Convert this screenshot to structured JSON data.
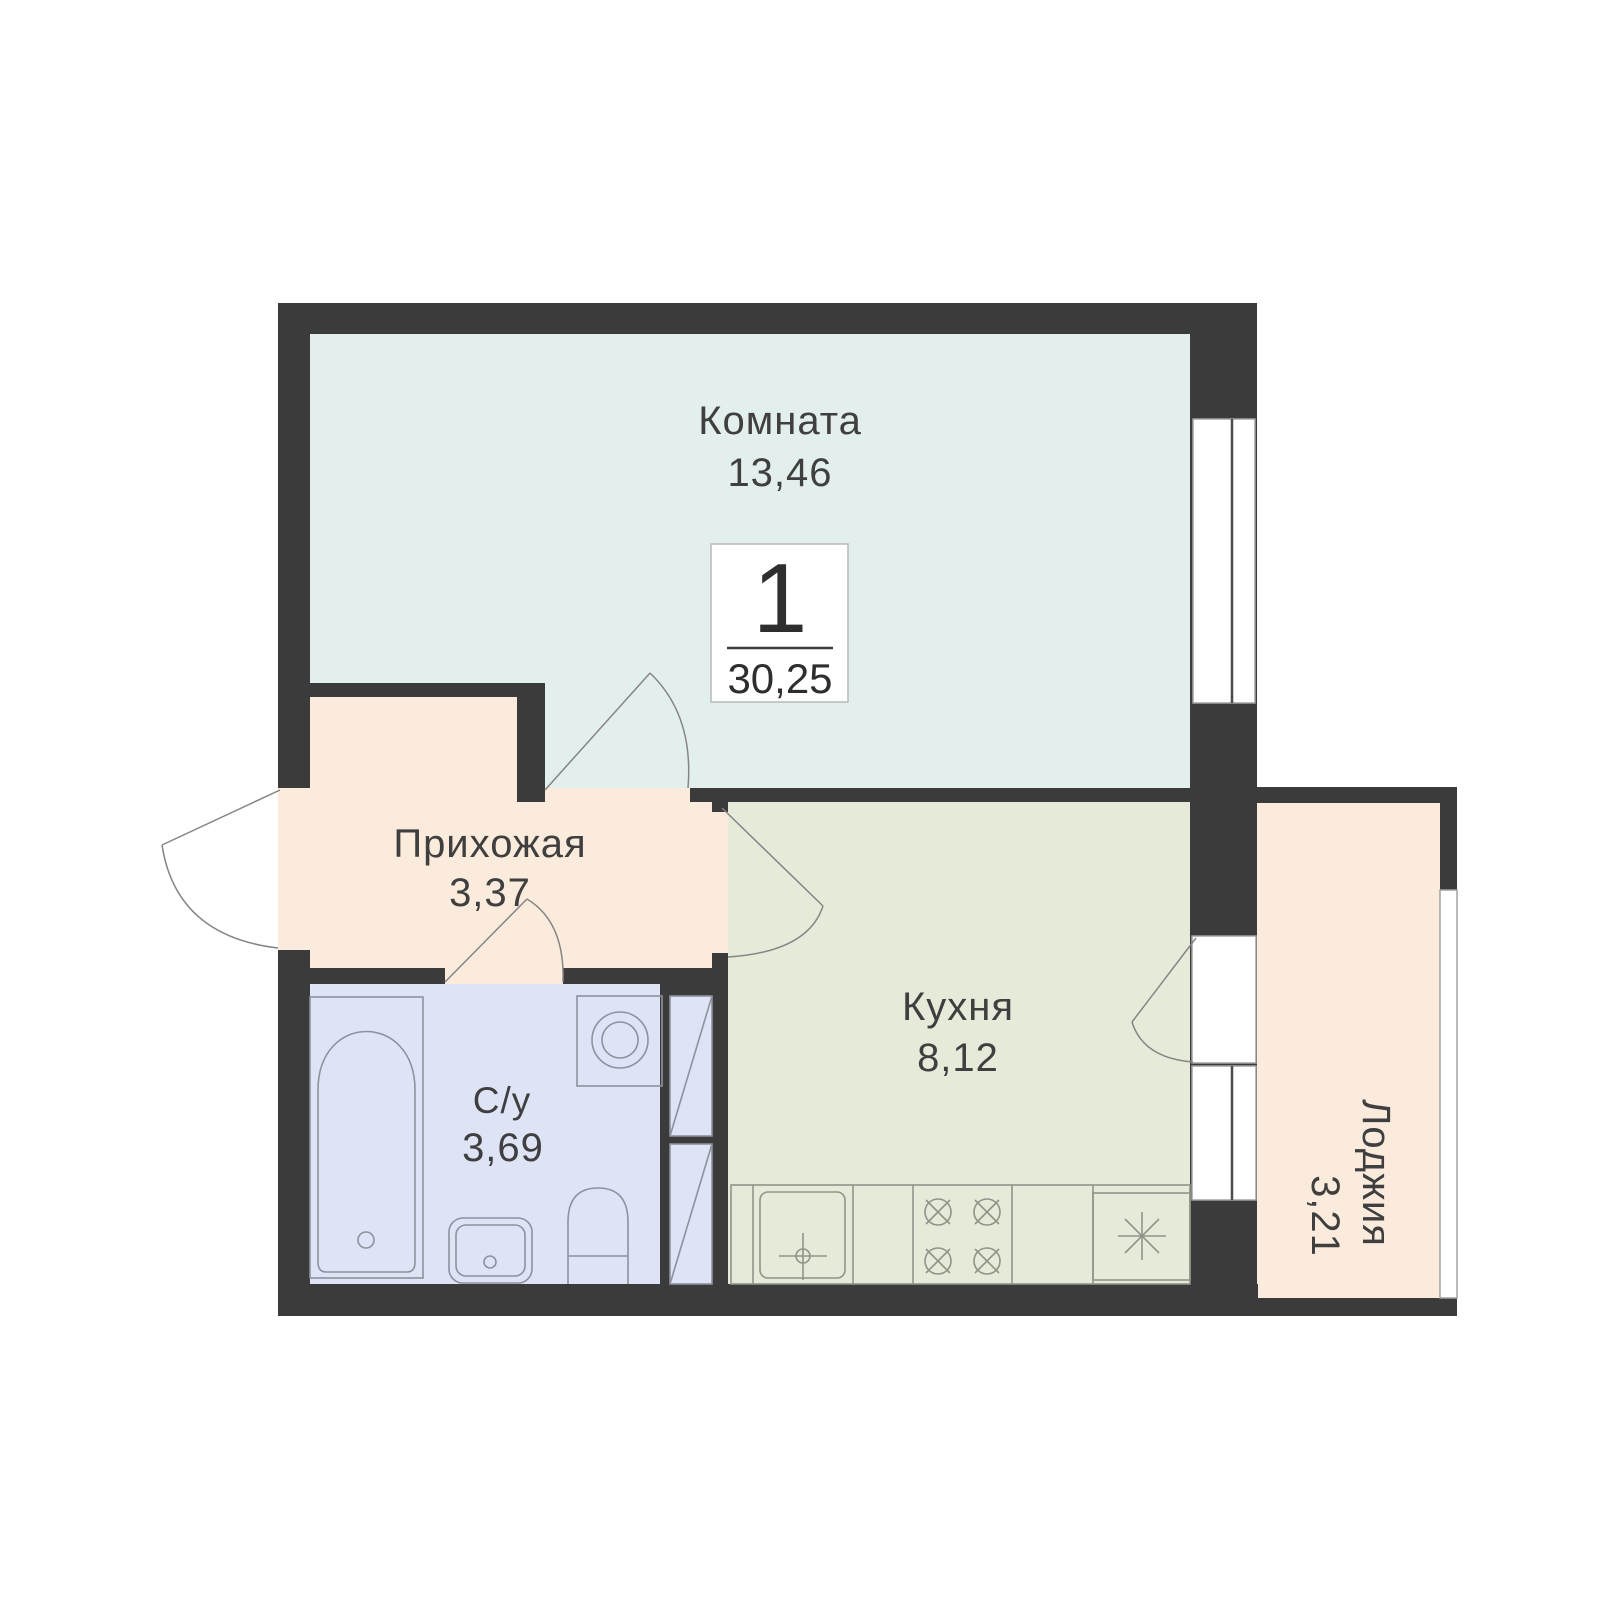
{
  "plan": {
    "badge": {
      "room_count": "1",
      "total_area": "30,25"
    },
    "rooms": [
      {
        "name": "Комната",
        "area": "13,46",
        "color": "#e3efed"
      },
      {
        "name": "Прихожая",
        "area": "3,37",
        "color": "#fbebdc"
      },
      {
        "name": "С/у",
        "area": "3,69",
        "color": "#dfe3f6"
      },
      {
        "name": "Кухня",
        "area": "8,12",
        "color": "#e5ead9"
      },
      {
        "name": "Лоджия",
        "area": "3,21",
        "color": "#fbebdc"
      }
    ],
    "colors": {
      "wall": "#3b3b3b",
      "background": "#ffffff",
      "text": "#3f3f3f"
    }
  }
}
